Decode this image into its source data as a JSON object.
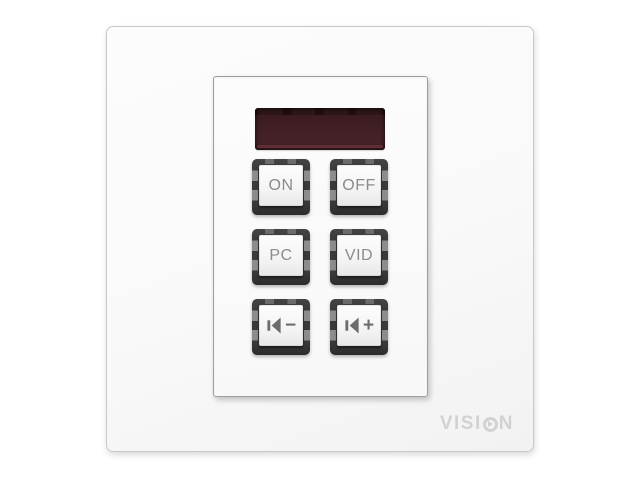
{
  "device": {
    "type": "wall-control-keypad",
    "brand": "VISION"
  },
  "brand": {
    "full": "VISION",
    "prefix": "VISI",
    "suffix": "N",
    "o_icon": "play-icon",
    "color": "#d2d2d2"
  },
  "display": {
    "name": "led-display",
    "state": "off",
    "text": "",
    "color": "#401f24"
  },
  "keypad": {
    "keys": [
      {
        "id": "on",
        "label": "ON"
      },
      {
        "id": "off",
        "label": "OFF"
      },
      {
        "id": "pc",
        "label": "PC"
      },
      {
        "id": "vid",
        "label": "VID"
      },
      {
        "id": "volume-down",
        "icon": "speaker-minus-icon",
        "sign": "−"
      },
      {
        "id": "volume-up",
        "icon": "speaker-plus-icon",
        "sign": "+"
      }
    ],
    "key_frame_color": "#3d3d3d",
    "key_label_color": "#8b8b8b",
    "icon_color": "#6c6c6c"
  }
}
